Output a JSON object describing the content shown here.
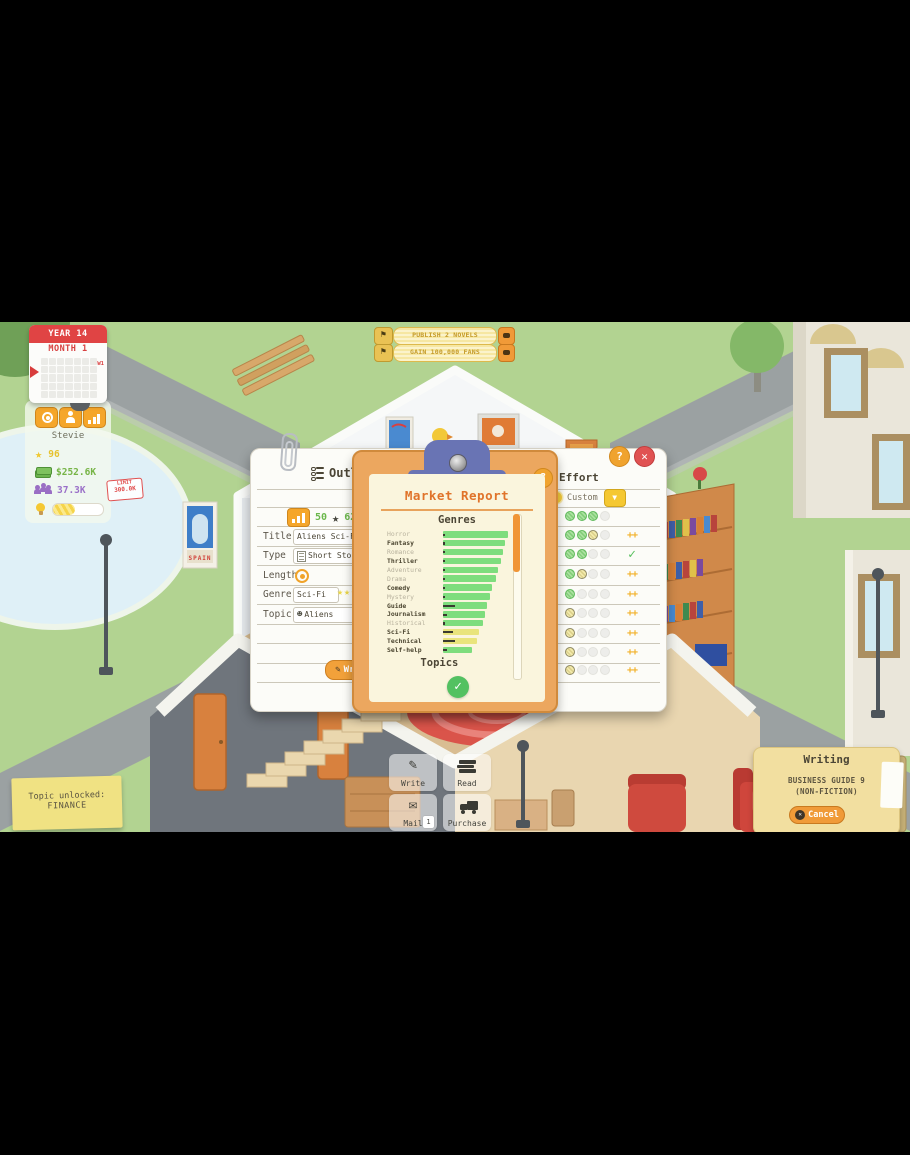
{
  "colors": {
    "accent_orange": "#f09a38",
    "clip_blue": "#6974b4",
    "bar_green": "#7edd7d",
    "bar_yellow": "#e9e47c",
    "scroll_thumb": "#f09536",
    "goal_text_gold": "#c49a28",
    "money_green": "#76b446",
    "fans_purple": "#9a70c8",
    "skill_yellow": "#e6c22e",
    "limit_red": "#e05050",
    "paper_cream": "#faf5dd"
  },
  "hud": {
    "calendar": {
      "year": "YEAR 14",
      "month": "MONTH 1",
      "week": "W1"
    },
    "goals": [
      {
        "label": "PUBLISH 2 NOVELS"
      },
      {
        "label": "GAIN 100,000 FANS"
      }
    ],
    "player": {
      "name": "Stevie",
      "skill": "96",
      "money": "$252.6K",
      "fans": "37.3K",
      "limit_line1": "LIMIT",
      "limit_line2": "300.0K",
      "idea_progress_pct": 44
    },
    "toast": {
      "line1": "Topic unlocked:",
      "line2": "FINANCE"
    }
  },
  "outline_panel": {
    "title": "Outline",
    "popularity_score": "50",
    "quality_score": "62",
    "fields": {
      "title": {
        "label": "Title",
        "value": "Aliens Sci-Fi 2"
      },
      "type": {
        "label": "Type",
        "value": "Short Story"
      },
      "length": {
        "label": "Length"
      },
      "genre": {
        "label": "Genre",
        "value": "Sci-Fi",
        "stars": 3
      },
      "topic": {
        "label": "Topic",
        "value": "Aliens"
      }
    },
    "write_button": "Write"
  },
  "effort_panel": {
    "title": "Effort",
    "custom_label": "Custom",
    "plus_symbol": "++",
    "rows": [
      {
        "pips": [
          "green",
          "green",
          "green",
          "gray"
        ],
        "marker": "none"
      },
      {
        "pips": [
          "green",
          "green",
          "yellow",
          "gray"
        ],
        "marker": "plus"
      },
      {
        "pips": [
          "green",
          "green",
          "gray",
          "gray"
        ],
        "marker": "check"
      },
      {
        "pips": [
          "green",
          "yellow",
          "gray",
          "gray"
        ],
        "marker": "plus"
      },
      {
        "pips": [
          "green",
          "gray",
          "gray",
          "gray"
        ],
        "marker": "plus"
      },
      {
        "pips": [
          "yellow",
          "gray",
          "gray",
          "gray"
        ],
        "marker": "plus"
      },
      {
        "pips": [
          "yellow",
          "gray",
          "gray",
          "gray"
        ],
        "marker": "plus"
      },
      {
        "pips": [
          "yellow",
          "gray",
          "gray",
          "gray"
        ],
        "marker": "plus"
      },
      {
        "pips": [
          "yellow",
          "gray",
          "gray",
          "gray"
        ],
        "marker": "plus"
      }
    ]
  },
  "market_report": {
    "title": "Market Report",
    "genres_heading": "Genres",
    "topics_heading": "Topics"
  },
  "chart_data": {
    "type": "bar",
    "orientation": "horizontal",
    "title": "Market Report",
    "section": "Genres",
    "categories": [
      "Horror",
      "Fantasy",
      "Romance",
      "Thriller",
      "Adventure",
      "Drama",
      "Comedy",
      "Mystery",
      "Guide",
      "Journalism",
      "Historical",
      "Sci-Fi",
      "Technical",
      "Self-help"
    ],
    "values": [
      100,
      95,
      92,
      89,
      85,
      82,
      76,
      73,
      68,
      65,
      62,
      56,
      52,
      44
    ],
    "bar_colors": [
      "green",
      "green",
      "green",
      "green",
      "green",
      "green",
      "green",
      "green",
      "green",
      "green",
      "green",
      "yellow",
      "yellow",
      "green"
    ],
    "locked": [
      true,
      false,
      true,
      false,
      true,
      true,
      false,
      true,
      false,
      false,
      true,
      false,
      false,
      false
    ],
    "marker_px": [
      2,
      2,
      2,
      2,
      2,
      2,
      2,
      2,
      12,
      4,
      2,
      10,
      12,
      4
    ],
    "xlim": [
      0,
      100
    ],
    "legend": "none"
  },
  "actions": {
    "write": {
      "label": "Write"
    },
    "read": {
      "label": "Read"
    },
    "mail": {
      "label": "Mail",
      "badge": "1"
    },
    "purchase": {
      "label": "Purchase"
    }
  },
  "writing_panel": {
    "title": "Writing",
    "book_line1": "BUSINESS GUIDE 9",
    "book_line2": "(NON-FICTION)",
    "cancel_label": "Cancel"
  }
}
